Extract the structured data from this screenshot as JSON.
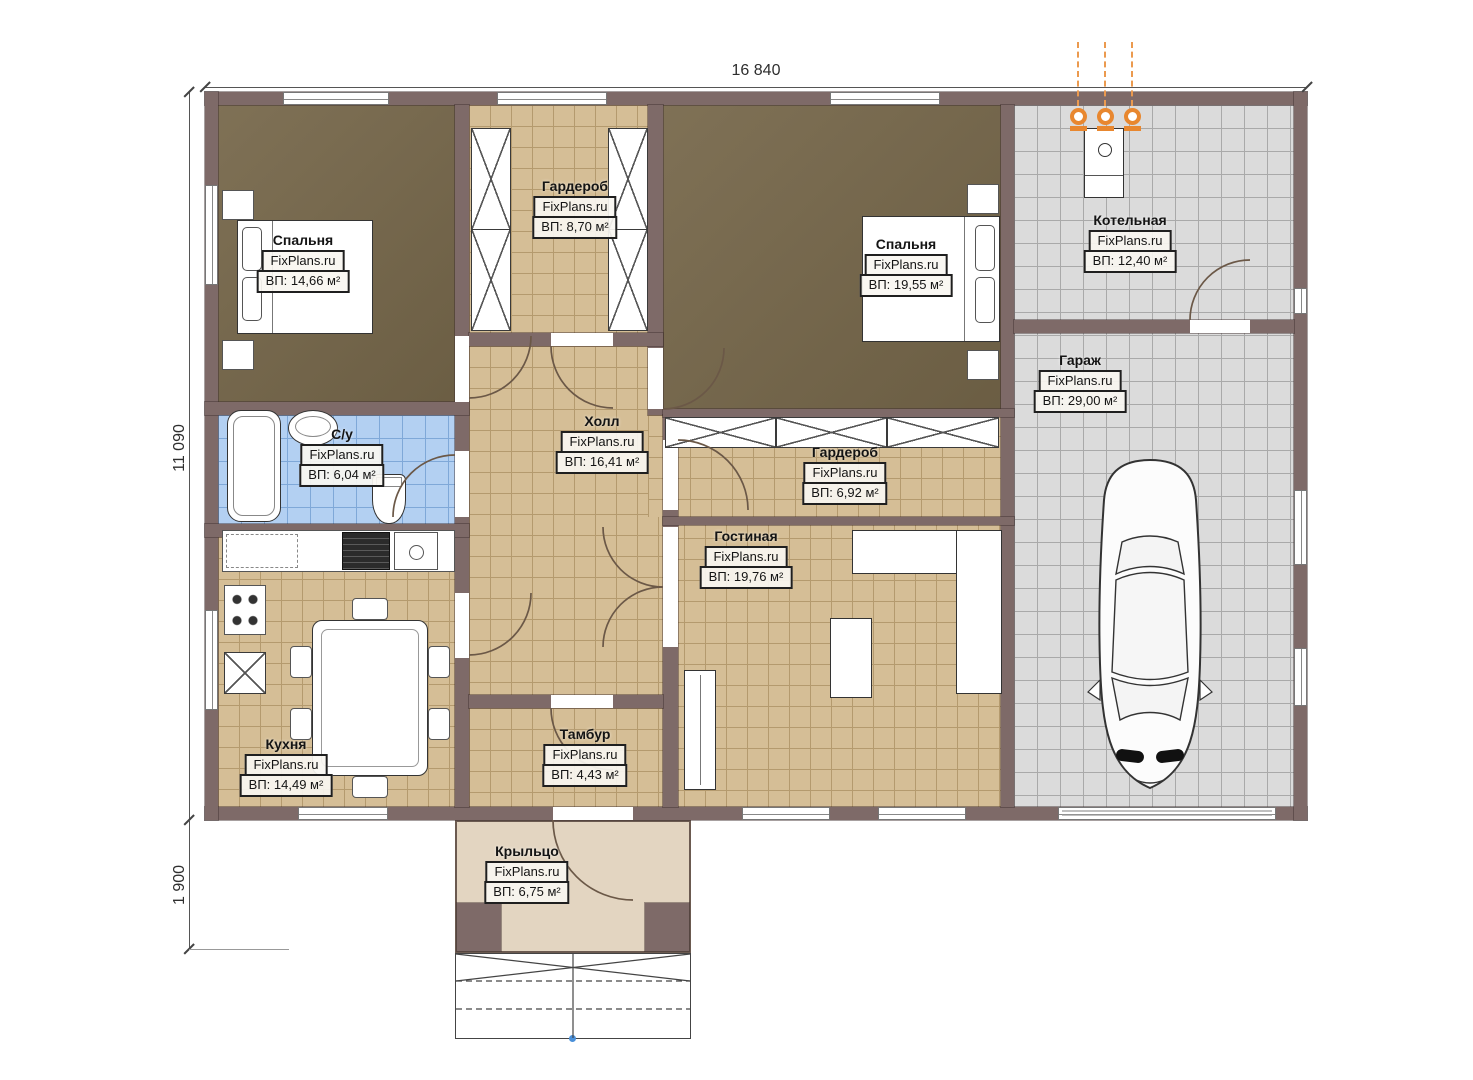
{
  "plan": {
    "dimensions": {
      "width": "16 840",
      "height": "11 090",
      "porch_depth": "1 900"
    },
    "brand": "FixPlans.ru",
    "rooms": [
      {
        "name": "Спальня",
        "brand": "FixPlans.ru",
        "area": "ВП: 14,66 м²"
      },
      {
        "name": "Гардероб",
        "brand": "FixPlans.ru",
        "area": "ВП: 8,70 м²"
      },
      {
        "name": "Спальня",
        "brand": "FixPlans.ru",
        "area": "ВП: 19,55 м²"
      },
      {
        "name": "Котельная",
        "brand": "FixPlans.ru",
        "area": "ВП: 12,40 м²"
      },
      {
        "name": "Гараж",
        "brand": "FixPlans.ru",
        "area": "ВП: 29,00 м²"
      },
      {
        "name": "Холл",
        "brand": "FixPlans.ru",
        "area": "ВП: 16,41 м²"
      },
      {
        "name": "С/у",
        "brand": "FixPlans.ru",
        "area": "ВП: 6,04 м²"
      },
      {
        "name": "Гардероб",
        "brand": "FixPlans.ru",
        "area": "ВП: 6,92 м²"
      },
      {
        "name": "Гостиная",
        "brand": "FixPlans.ru",
        "area": "ВП: 19,76 м²"
      },
      {
        "name": "Кухня",
        "brand": "FixPlans.ru",
        "area": "ВП: 14,49 м²"
      },
      {
        "name": "Тамбур",
        "brand": "FixPlans.ru",
        "area": "ВП: 4,43 м²"
      },
      {
        "name": "Крыльцо",
        "brand": "FixPlans.ru",
        "area": "ВП: 6,75 м²"
      }
    ],
    "colors": {
      "wall": "#7e6a68",
      "tile_tan": "#d5be96",
      "tile_blue": "#b3d0f2",
      "tile_gray": "#dbdbdb",
      "bedroom_floor": "#77684b",
      "porch": "#e3d5c1",
      "accent_orange": "#e8872f"
    }
  }
}
